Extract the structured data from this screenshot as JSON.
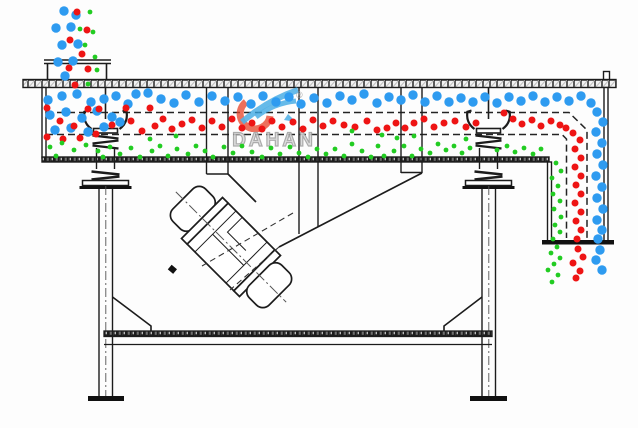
{
  "watermark": {
    "brand": "DAHAN",
    "registered": "®"
  },
  "colors": {
    "particle_blue": "#2e9bf0",
    "particle_red": "#ee1414",
    "particle_green": "#22cc22",
    "line_black": "#1c1c1c",
    "hatch_gray": "#9b9b9b",
    "watermark_text_gray": "#9f9f9f",
    "watermark_logo_red": "#e8452b",
    "watermark_logo_blue": "#39a5e2"
  },
  "particles": {
    "blue": {
      "r": 4.7,
      "points": [
        [
          64,
          11
        ],
        [
          76,
          15
        ],
        [
          56,
          28
        ],
        [
          71,
          27
        ],
        [
          62,
          45
        ],
        [
          78,
          44
        ],
        [
          58,
          62
        ],
        [
          73,
          61
        ],
        [
          65,
          76
        ],
        [
          48,
          100
        ],
        [
          62,
          96
        ],
        [
          77,
          94
        ],
        [
          91,
          102
        ],
        [
          104,
          99
        ],
        [
          116,
          96
        ],
        [
          128,
          104
        ],
        [
          50,
          115
        ],
        [
          66,
          112
        ],
        [
          82,
          118
        ],
        [
          97,
          111
        ],
        [
          112,
          117
        ],
        [
          55,
          130
        ],
        [
          71,
          128
        ],
        [
          88,
          132
        ],
        [
          104,
          127
        ],
        [
          120,
          122
        ],
        [
          136,
          94
        ],
        [
          148,
          93
        ],
        [
          161,
          99
        ],
        [
          174,
          103
        ],
        [
          186,
          95
        ],
        [
          199,
          102
        ],
        [
          212,
          96
        ],
        [
          225,
          101
        ],
        [
          238,
          97
        ],
        [
          251,
          104
        ],
        [
          263,
          96
        ],
        [
          276,
          102
        ],
        [
          289,
          97
        ],
        [
          301,
          104
        ],
        [
          314,
          98
        ],
        [
          327,
          103
        ],
        [
          340,
          96
        ],
        [
          352,
          100
        ],
        [
          364,
          94
        ],
        [
          377,
          103
        ],
        [
          389,
          97
        ],
        [
          401,
          100
        ],
        [
          413,
          95
        ],
        [
          425,
          102
        ],
        [
          437,
          96
        ],
        [
          449,
          102
        ],
        [
          461,
          98
        ],
        [
          473,
          102
        ],
        [
          485,
          97
        ],
        [
          497,
          103
        ],
        [
          509,
          97
        ],
        [
          521,
          101
        ],
        [
          533,
          96
        ],
        [
          545,
          102
        ],
        [
          557,
          97
        ],
        [
          569,
          101
        ],
        [
          581,
          96
        ],
        [
          591,
          103
        ],
        [
          597,
          112
        ],
        [
          603,
          122
        ],
        [
          596,
          132
        ],
        [
          602,
          143
        ],
        [
          597,
          154
        ],
        [
          603,
          165
        ],
        [
          596,
          176
        ],
        [
          602,
          187
        ],
        [
          597,
          198
        ],
        [
          603,
          209
        ],
        [
          597,
          220
        ],
        [
          602,
          230
        ],
        [
          598,
          239
        ],
        [
          600,
          250
        ],
        [
          596,
          260
        ],
        [
          602,
          270
        ]
      ]
    },
    "red": {
      "r": 3.5,
      "points": [
        [
          77,
          12
        ],
        [
          87,
          30
        ],
        [
          70,
          40
        ],
        [
          82,
          54
        ],
        [
          69,
          68
        ],
        [
          88,
          69
        ],
        [
          75,
          85
        ],
        [
          47,
          108
        ],
        [
          60,
          121
        ],
        [
          74,
          126
        ],
        [
          88,
          109
        ],
        [
          99,
          109
        ],
        [
          112,
          125
        ],
        [
          126,
          108
        ],
        [
          131,
          121
        ],
        [
          142,
          131
        ],
        [
          47,
          137
        ],
        [
          63,
          139
        ],
        [
          80,
          138
        ],
        [
          96,
          134
        ],
        [
          150,
          108
        ],
        [
          155,
          126
        ],
        [
          163,
          119
        ],
        [
          172,
          129
        ],
        [
          182,
          124
        ],
        [
          192,
          120
        ],
        [
          202,
          128
        ],
        [
          212,
          121
        ],
        [
          222,
          127
        ],
        [
          232,
          119
        ],
        [
          242,
          128
        ],
        [
          252,
          123
        ],
        [
          262,
          129
        ],
        [
          272,
          121
        ],
        [
          282,
          127
        ],
        [
          293,
          122
        ],
        [
          303,
          129
        ],
        [
          313,
          120
        ],
        [
          323,
          126
        ],
        [
          333,
          121
        ],
        [
          344,
          125
        ],
        [
          355,
          127
        ],
        [
          367,
          121
        ],
        [
          377,
          130
        ],
        [
          387,
          128
        ],
        [
          396,
          123
        ],
        [
          405,
          128
        ],
        [
          414,
          123
        ],
        [
          424,
          119
        ],
        [
          434,
          127
        ],
        [
          444,
          123
        ],
        [
          455,
          121
        ],
        [
          466,
          127
        ],
        [
          476,
          123
        ],
        [
          504,
          113
        ],
        [
          513,
          119
        ],
        [
          522,
          124
        ],
        [
          532,
          120
        ],
        [
          541,
          126
        ],
        [
          551,
          121
        ],
        [
          560,
          125
        ],
        [
          566,
          128
        ],
        [
          573,
          133
        ],
        [
          580,
          140
        ],
        [
          575,
          149
        ],
        [
          581,
          158
        ],
        [
          575,
          167
        ],
        [
          581,
          176
        ],
        [
          576,
          185
        ],
        [
          581,
          194
        ],
        [
          575,
          203
        ],
        [
          581,
          212
        ],
        [
          576,
          221
        ],
        [
          581,
          230
        ],
        [
          577,
          239
        ],
        [
          578,
          249
        ],
        [
          583,
          257
        ],
        [
          573,
          263
        ],
        [
          580,
          271
        ],
        [
          576,
          278
        ]
      ]
    },
    "green": {
      "r": 2.4,
      "points": [
        [
          90,
          12
        ],
        [
          93,
          32
        ],
        [
          85,
          45
        ],
        [
          95,
          57
        ],
        [
          80,
          29
        ],
        [
          97,
          70
        ],
        [
          88,
          84
        ],
        [
          50,
          147
        ],
        [
          62,
          143
        ],
        [
          74,
          150
        ],
        [
          86,
          145
        ],
        [
          98,
          151
        ],
        [
          110,
          147
        ],
        [
          56,
          156
        ],
        [
          103,
          157
        ],
        [
          120,
          154
        ],
        [
          131,
          148
        ],
        [
          140,
          157
        ],
        [
          152,
          151
        ],
        [
          160,
          146
        ],
        [
          168,
          156
        ],
        [
          177,
          149
        ],
        [
          188,
          154
        ],
        [
          196,
          146
        ],
        [
          205,
          151
        ],
        [
          213,
          157
        ],
        [
          224,
          147
        ],
        [
          233,
          153
        ],
        [
          242,
          146
        ],
        [
          252,
          152
        ],
        [
          262,
          157
        ],
        [
          271,
          148
        ],
        [
          280,
          154
        ],
        [
          290,
          147
        ],
        [
          299,
          153
        ],
        [
          308,
          157
        ],
        [
          317,
          149
        ],
        [
          326,
          154
        ],
        [
          335,
          149
        ],
        [
          344,
          156
        ],
        [
          352,
          144
        ],
        [
          362,
          151
        ],
        [
          371,
          157
        ],
        [
          378,
          146
        ],
        [
          384,
          156
        ],
        [
          394,
          151
        ],
        [
          404,
          146
        ],
        [
          412,
          156
        ],
        [
          421,
          149
        ],
        [
          430,
          153
        ],
        [
          438,
          144
        ],
        [
          446,
          150
        ],
        [
          454,
          146
        ],
        [
          462,
          153
        ],
        [
          470,
          148
        ],
        [
          497,
          150
        ],
        [
          507,
          146
        ],
        [
          515,
          152
        ],
        [
          524,
          148
        ],
        [
          533,
          154
        ],
        [
          541,
          149
        ],
        [
          150,
          139
        ],
        [
          176,
          136
        ],
        [
          352,
          131
        ],
        [
          382,
          135
        ],
        [
          397,
          138
        ],
        [
          414,
          136
        ],
        [
          466,
          139
        ],
        [
          556,
          163
        ],
        [
          561,
          171
        ],
        [
          552,
          178
        ],
        [
          558,
          186
        ],
        [
          553,
          194
        ],
        [
          560,
          201
        ],
        [
          554,
          209
        ],
        [
          561,
          217
        ],
        [
          555,
          225
        ],
        [
          560,
          232
        ],
        [
          553,
          239
        ],
        [
          557,
          247
        ],
        [
          551,
          253
        ],
        [
          560,
          258
        ],
        [
          554,
          264
        ],
        [
          548,
          270
        ],
        [
          558,
          275
        ],
        [
          552,
          282
        ]
      ]
    }
  }
}
